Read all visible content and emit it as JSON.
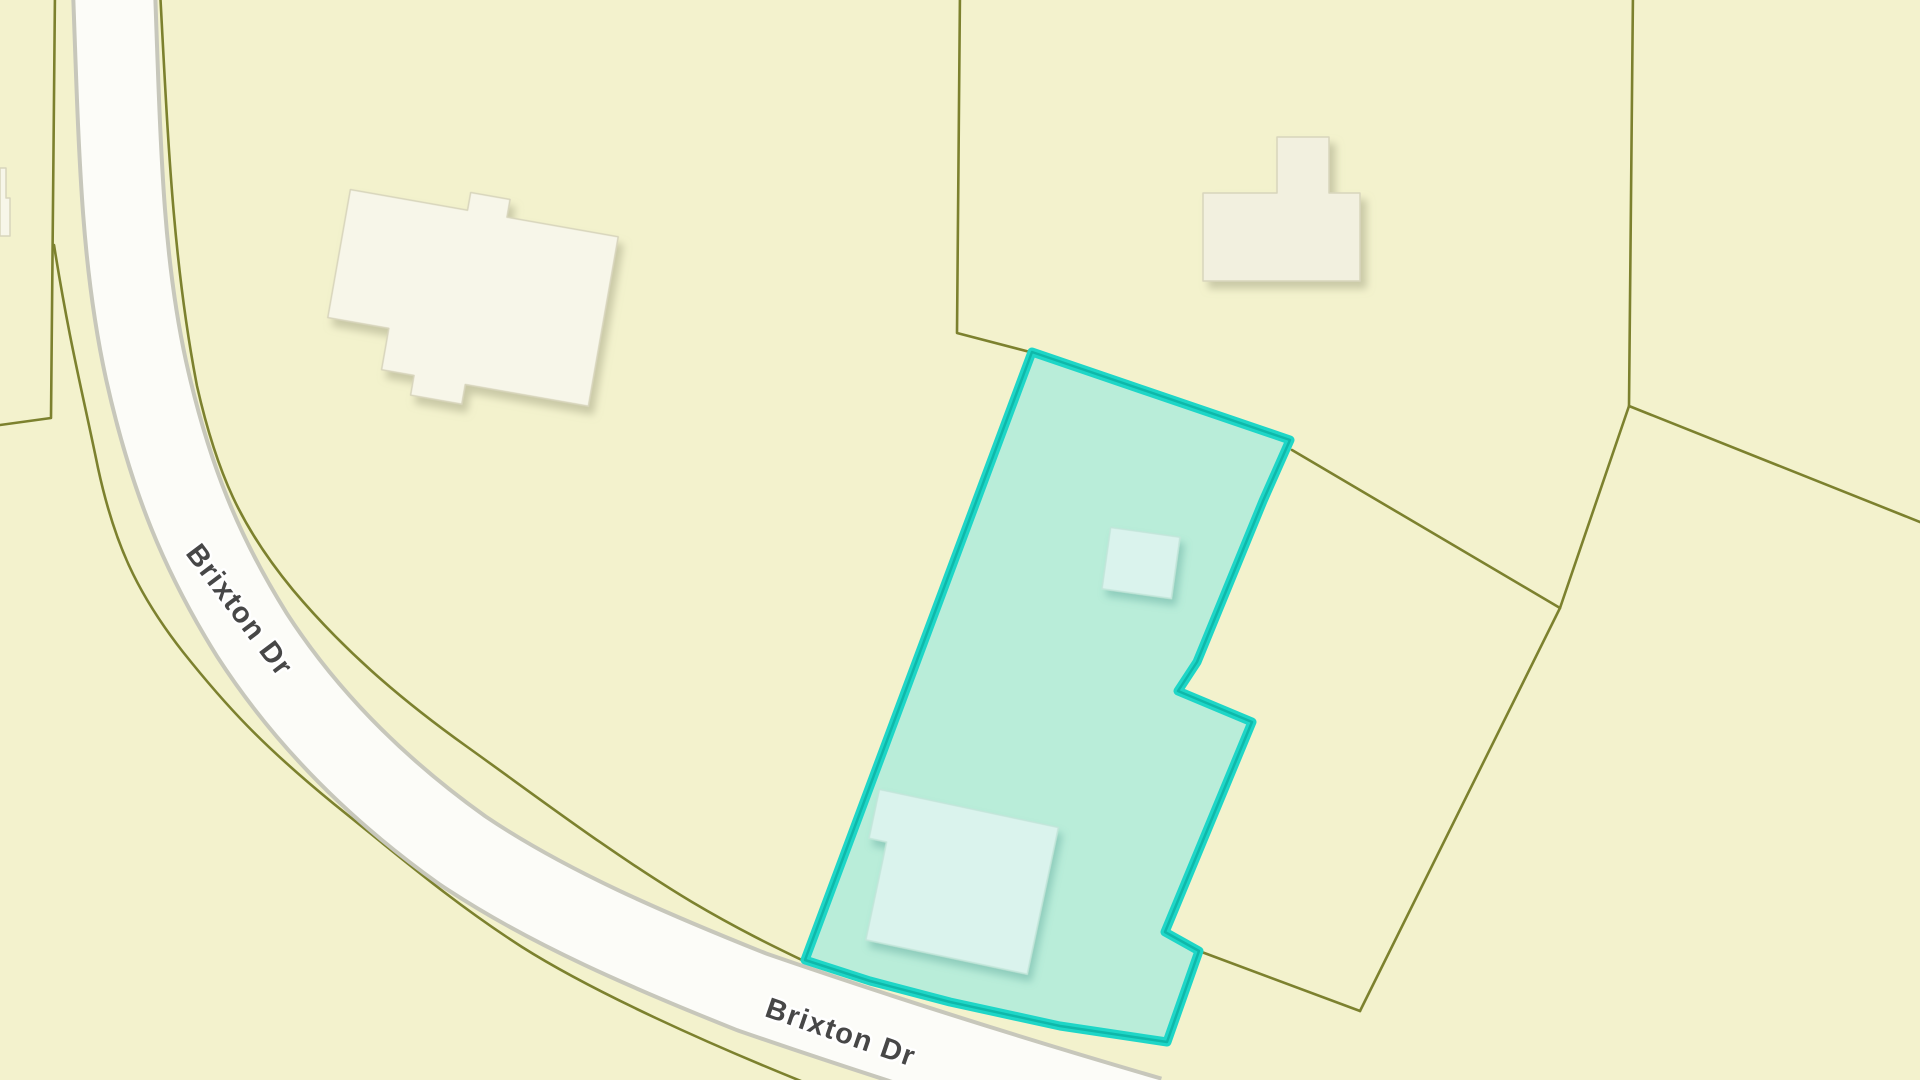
{
  "map": {
    "street": {
      "name": "Brixton Dr",
      "label_upper": "Brixton Dr",
      "label_lower": "Brixton Dr"
    },
    "selected_parcel": {
      "state": "selected"
    },
    "colors": {
      "background": "#f3f2cd",
      "boundary_line": "#7c812e",
      "road_fill": "#fcfcf8",
      "road_casing": "#c7c7bb",
      "selected_fill": "#b9edd9",
      "selected_stroke": "#1ed6c7",
      "selected_stroke_core": "#0db3a5",
      "building_fill": "#f7f6e9",
      "building_fill_alt": "#f2f0df",
      "selected_building_fill": "#daf3ed",
      "street_label": "#474747",
      "street_label_halo": "#ffffff"
    }
  }
}
